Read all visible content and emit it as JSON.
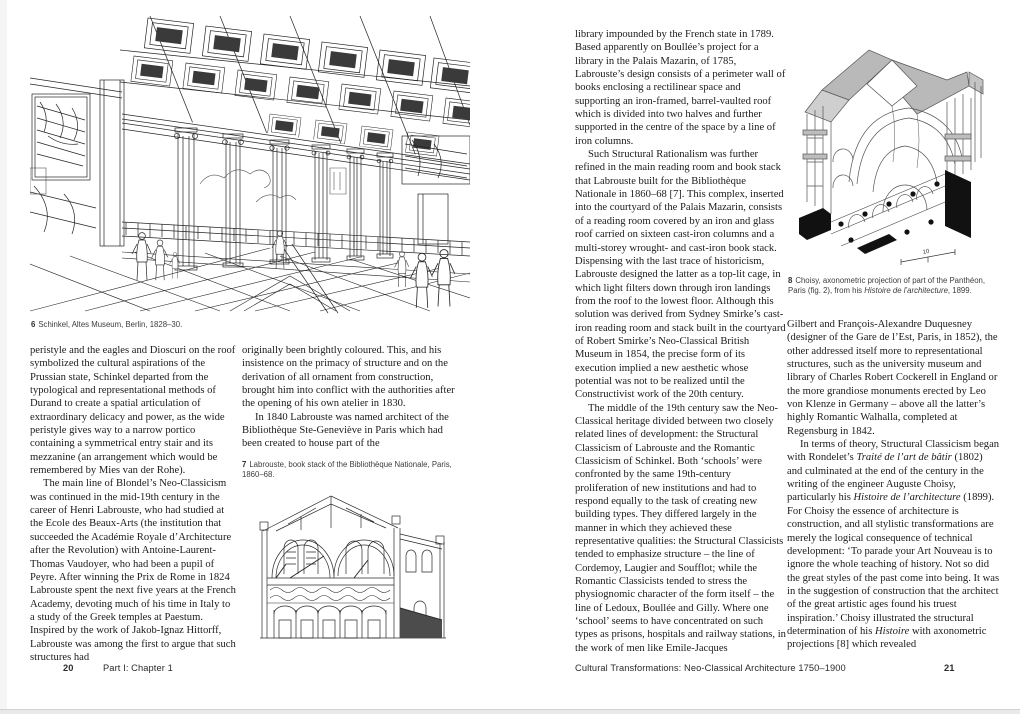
{
  "colors": {
    "ink": "#1b1b1b",
    "caption": "#3d3d3d",
    "paper": "#ffffff",
    "edge": "#d2d2d2"
  },
  "left": {
    "figure6": {
      "num": "6",
      "caption": "Schinkel, Altes Museum, Berlin, 1828–30."
    },
    "col1": [
      "peristyle and the eagles and Dioscuri on the roof symbolized the cultural aspirations of the Prussian state, Schinkel departed from the typological and representational methods of Durand to create a spatial articulation of extraordinary delicacy and power, as the wide peristyle gives way to a narrow portico containing a symmetrical entry stair and its mezzanine (an arrangement which would be remembered by Mies van der Rohe).",
      "The main line of Blondel’s Neo-Classicism was continued in the mid-19th century in the career of Henri Labrouste, who had studied at the Ecole des Beaux-Arts (the institution that succeeded the Académie Royale d’Architecture after the Revolution) with Antoine-Laurent-Thomas Vaudoyer, who had been a pupil of Peyre. After winning the Prix de Rome in 1824 Labrouste spent the next five years at the French Academy, devoting much of his time in Italy to a study of the Greek temples at Paestum. Inspired by the work of Jakob-Ignaz Hittorff, Labrouste was among the first to argue that such structures had"
    ],
    "col2": [
      "originally been brightly coloured. This, and his insistence on the primacy of structure and on the derivation of all ornament from construction, brought him into conflict with the authorities after the opening of his own atelier in 1830.",
      "In 1840 Labrouste was named architect of the Bibliothèque Ste-Geneviève in Paris which had been created to house part of the"
    ],
    "figure7": {
      "num": "7",
      "caption": "Labrouste, book stack of the Bibliothèque Nationale, Paris, 1860–68."
    },
    "footer": {
      "page_num": "20",
      "chapter": "Part I: Chapter 1"
    }
  },
  "right": {
    "col1": [
      "library impounded by the French state in 1789. Based apparently on Boullée’s project for a library in the Palais Mazarin, of 1785, Labrouste’s design consists of a perimeter wall of books enclosing a rectilinear space and supporting an iron-framed, barrel-vaulted roof which is divided into two halves and further supported in the centre of the space by a line of iron columns.",
      "Such Structural Rationalism was further refined in the main reading room and book stack that Labrouste built for the Bibliothèque Nationale in 1860–68 [7]. This complex, inserted into the courtyard of the Palais Mazarin, consists of a reading room covered by an iron and glass roof carried on sixteen cast-iron columns and a multi-storey wrought- and cast-iron book stack. Dispensing with the last trace of historicism, Labrouste designed the latter as a top-lit cage, in which light filters down through iron landings from the roof to the lowest floor. Although this solution was derived from Sydney Smirke’s cast-iron reading room and stack built in the courtyard of Robert Smirke’s Neo-Classical British Museum in 1854, the precise form of its execution implied a new aesthetic whose potential was not to be realized until the Constructivist work of the 20th century.",
      "The middle of the 19th century saw the Neo-Classical heritage divided between two closely related lines of development: the Structural Classicism of Labrouste and the Romantic Classicism of Schinkel. Both ‘schools’ were confronted by the same 19th-century proliferation of new institutions and had to respond equally to the task of creating new building types. They differed largely in the manner in which they achieved these representative qualities: the Structural Classicists tended to emphasize structure – the line of Cordemoy, Laugier and Soufflot; while the Romantic Classicists tended to stress the physiognomic character of the form itself – the line of Ledoux, Boullée and Gilly. Where one ‘school’ seems to have concentrated on such types as prisons, hospitals and railway stations, in the work of men like Emile-Jacques"
    ],
    "figure8": {
      "num": "8",
      "caption": "Choisy, axonometric projection of part of the Panthéon, Paris (fig. 2), from his *Histoire de l’architecture*, 1899.",
      "scale_label": "10"
    },
    "col2": [
      "Gilbert and François-Alexandre Duquesney (designer of the Gare de l’Est, Paris, in 1852), the other addressed itself more to representational structures, such as the university museum and library of Charles Robert Cockerell in England or the more grandiose monuments erected by Leo von Klenze in Germany – above all the latter’s highly Romantic Walhalla, completed at Regensburg in 1842.",
      "In terms of theory, Structural Classicism began with Rondelet’s *Traité de l’art de bâtir* (1802) and culminated at the end of the century in the writing of the engineer Auguste Choisy, particularly his *Histoire de l’architecture* (1899). For Choisy the essence of architecture is construction, and all stylistic transformations are merely the logical consequence of technical development: ‘To parade your Art Nouveau is to ignore the whole teaching of history. Not so did the great styles of the past come into being. It was in the suggestion of construction that the architect of the great artistic ages found his truest inspiration.’ Choisy illustrated the structural determination of his *Histoire* with axonometric projections [8] which revealed"
    ],
    "footer": {
      "title": "Cultural Transformations: Neo-Classical Architecture 1750–1900",
      "page_num": "21"
    }
  }
}
